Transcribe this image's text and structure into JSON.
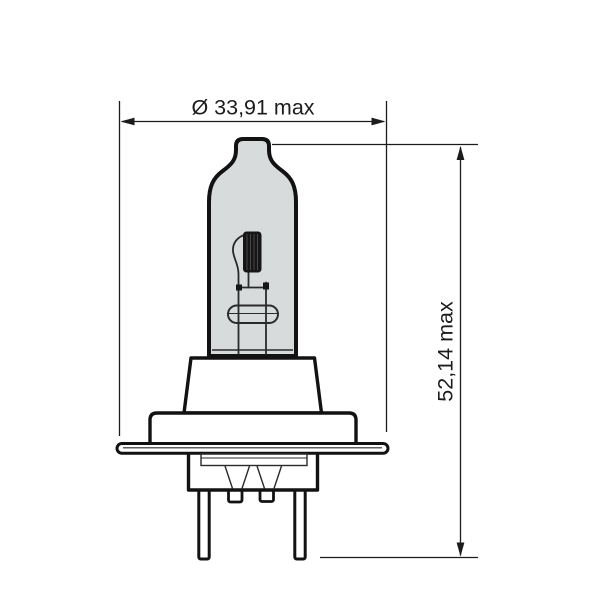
{
  "figure": {
    "title": "halogen-bulb-technical-drawing",
    "dimensions": {
      "width": {
        "label": "Ø 33,91 max"
      },
      "height": {
        "label": "52,14 max"
      }
    }
  },
  "colors": {
    "background": "#ffffff",
    "outline": "#121212",
    "glass_fill": "#d8dbdc",
    "inner_line": "#2a2a2a",
    "filament_fill": "#161616",
    "dim_line": "#1c1c1c"
  }
}
